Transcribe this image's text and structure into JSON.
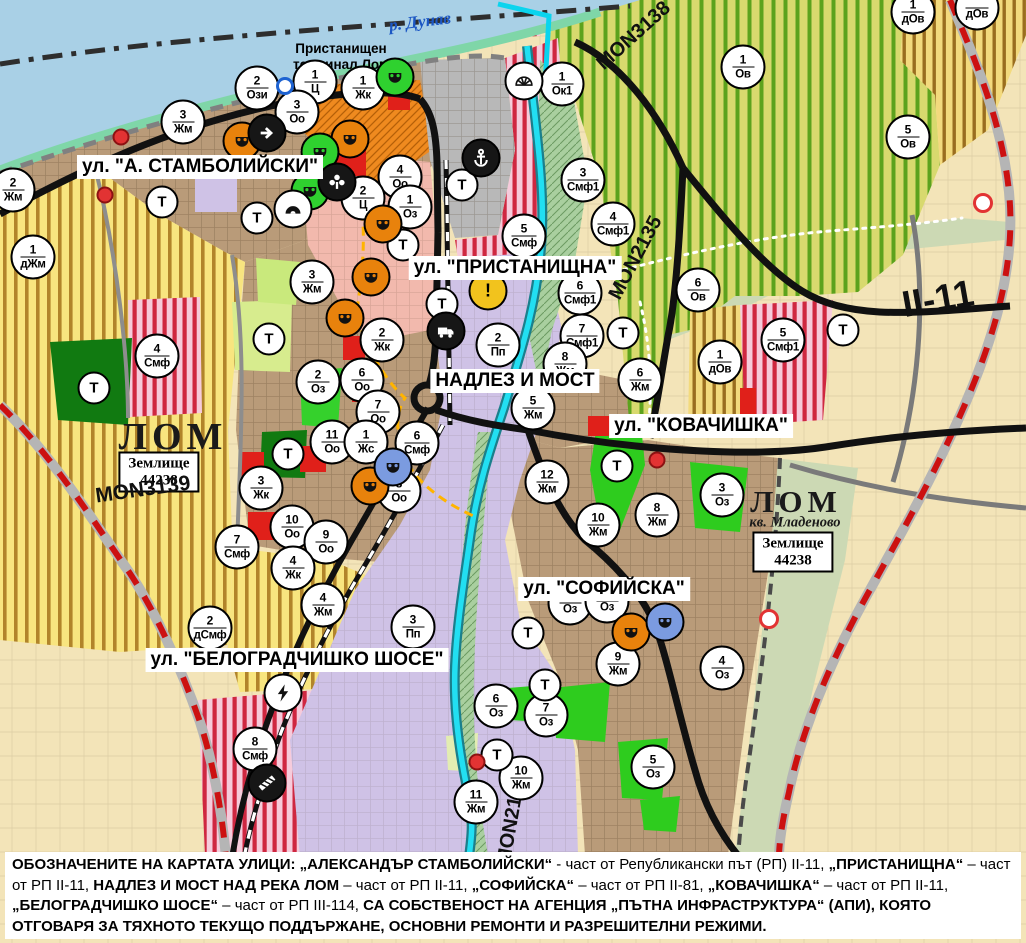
{
  "map": {
    "river_label": "р. Дунав",
    "terminal_label": "Пристанищен\nтерминал Лом",
    "t_label": "Т",
    "city_labels": [
      {
        "id": "lom-city",
        "text": "ЛОМ",
        "x": 173,
        "y": 437,
        "size": 38
      },
      {
        "id": "lom-mladenovo",
        "text": "ЛОМ",
        "x": 796,
        "y": 502,
        "size": 31
      }
    ],
    "district_label": {
      "text": "кв. Младеново",
      "x": 795,
      "y": 523
    },
    "land_plots": [
      {
        "line1": "Землище",
        "line2": "44238",
        "x": 159,
        "y": 472
      },
      {
        "line1": "Землище",
        "line2": "44238",
        "x": 793,
        "y": 552
      }
    ],
    "street_labels": [
      {
        "id": "stamboliyski",
        "text": "ул. \"А. СТАМБОЛИЙСКИ\"",
        "x": 200,
        "y": 167
      },
      {
        "id": "pristanishtna",
        "text": "ул. \"ПРИСТАНИЩНА\"",
        "x": 515,
        "y": 268
      },
      {
        "id": "nadlez-i-most",
        "text": "НАДЛЕЗ И МОСТ",
        "x": 515,
        "y": 381
      },
      {
        "id": "kovachishka",
        "text": "ул. \"КОВАЧИШКА\"",
        "x": 701,
        "y": 426
      },
      {
        "id": "sofiyska",
        "text": "ул. \"СОФИЙСКА\"",
        "x": 604,
        "y": 589
      },
      {
        "id": "belogradchishko-shose",
        "text": "ул. \"БЕЛОГРАДЧИШКО ШОСЕ\"",
        "x": 297,
        "y": 660
      }
    ],
    "road_labels": [
      {
        "id": "mon3139",
        "text": "MON3139",
        "x": 143,
        "y": 490,
        "rot": -8,
        "size": 21
      },
      {
        "id": "mon3138",
        "text": "MON3138",
        "x": 634,
        "y": 36,
        "rot": -42,
        "size": 20
      },
      {
        "id": "mon2135",
        "text": "MON2135",
        "x": 636,
        "y": 258,
        "rot": -62,
        "size": 20
      },
      {
        "id": "mon2136",
        "text": "MON2136",
        "x": 512,
        "y": 820,
        "rot": -80,
        "size": 20
      },
      {
        "id": "ii-11",
        "text": "II-11",
        "x": 938,
        "y": 299,
        "rot": -10,
        "size": 37
      }
    ],
    "zone_markers": [
      {
        "n": "2",
        "c": "Ози",
        "x": 257,
        "y": 88
      },
      {
        "n": "1",
        "c": "Ц",
        "x": 315,
        "y": 82
      },
      {
        "n": "1",
        "c": "Жк",
        "x": 363,
        "y": 88
      },
      {
        "n": "3",
        "c": "Оо",
        "x": 297,
        "y": 112
      },
      {
        "n": "1",
        "c": "Ок1",
        "x": 562,
        "y": 84
      },
      {
        "n": "3",
        "c": "Жм",
        "x": 183,
        "y": 122
      },
      {
        "n": "2",
        "c": "Жм",
        "x": 13,
        "y": 190
      },
      {
        "n": "1",
        "c": "дЖм",
        "x": 33,
        "y": 257
      },
      {
        "n": "3",
        "c": "Смф1",
        "x": 583,
        "y": 180
      },
      {
        "n": "4",
        "c": "Оо",
        "x": 400,
        "y": 177
      },
      {
        "n": "2",
        "c": "Ц",
        "x": 363,
        "y": 198
      },
      {
        "n": "1",
        "c": "Оз",
        "x": 410,
        "y": 207
      },
      {
        "n": "4",
        "c": "Смф1",
        "x": 613,
        "y": 224
      },
      {
        "n": "5",
        "c": "Смф",
        "x": 524,
        "y": 236
      },
      {
        "n": "3",
        "c": "Жм",
        "x": 312,
        "y": 282
      },
      {
        "n": "6",
        "c": "Смф1",
        "x": 580,
        "y": 293
      },
      {
        "n": "7",
        "c": "Смф1",
        "x": 582,
        "y": 336
      },
      {
        "n": "2",
        "c": "Пп",
        "x": 498,
        "y": 345
      },
      {
        "n": "8",
        "c": "Жм",
        "x": 565,
        "y": 364
      },
      {
        "n": "6",
        "c": "Жм",
        "x": 640,
        "y": 380
      },
      {
        "n": "5",
        "c": "Жм",
        "x": 533,
        "y": 408
      },
      {
        "n": "2",
        "c": "Жк",
        "x": 382,
        "y": 340
      },
      {
        "n": "4",
        "c": "Смф",
        "x": 157,
        "y": 356
      },
      {
        "n": "2",
        "c": "Оз",
        "x": 318,
        "y": 382
      },
      {
        "n": "6",
        "c": "Оо",
        "x": 362,
        "y": 380
      },
      {
        "n": "7",
        "c": "Оо",
        "x": 378,
        "y": 412
      },
      {
        "n": "11",
        "c": "Оо",
        "x": 332,
        "y": 442
      },
      {
        "n": "1",
        "c": "Жс",
        "x": 366,
        "y": 442
      },
      {
        "n": "6",
        "c": "Смф",
        "x": 417,
        "y": 443
      },
      {
        "n": "8",
        "c": "Оо",
        "x": 399,
        "y": 491
      },
      {
        "n": "3",
        "c": "Жк",
        "x": 261,
        "y": 488
      },
      {
        "n": "12",
        "c": "Жм",
        "x": 547,
        "y": 482
      },
      {
        "n": "8",
        "c": "Жм",
        "x": 657,
        "y": 515
      },
      {
        "n": "3",
        "c": "Оз",
        "x": 722,
        "y": 495
      },
      {
        "n": "10",
        "c": "Жм",
        "x": 598,
        "y": 525
      },
      {
        "n": "10",
        "c": "Оо",
        "x": 292,
        "y": 527
      },
      {
        "n": "9",
        "c": "Оо",
        "x": 326,
        "y": 542
      },
      {
        "n": "7",
        "c": "Смф",
        "x": 237,
        "y": 547
      },
      {
        "n": "4",
        "c": "Жк",
        "x": 293,
        "y": 568
      },
      {
        "n": "4",
        "c": "Жм",
        "x": 323,
        "y": 605
      },
      {
        "n": "2",
        "c": "дСмф",
        "x": 210,
        "y": 628
      },
      {
        "n": "3",
        "c": "Пп",
        "x": 413,
        "y": 627
      },
      {
        "n": "8",
        "c": "Смф",
        "x": 255,
        "y": 749
      },
      {
        "n": "",
        "c": "Оз",
        "x": 570,
        "y": 603
      },
      {
        "n": "",
        "c": "Оз",
        "x": 607,
        "y": 601
      },
      {
        "n": "9",
        "c": "Жм",
        "x": 618,
        "y": 664
      },
      {
        "n": "4",
        "c": "Оз",
        "x": 722,
        "y": 668
      },
      {
        "n": "6",
        "c": "Оз",
        "x": 496,
        "y": 706
      },
      {
        "n": "7",
        "c": "Оз",
        "x": 546,
        "y": 715
      },
      {
        "n": "5",
        "c": "Оз",
        "x": 653,
        "y": 767
      },
      {
        "n": "10",
        "c": "Жм",
        "x": 521,
        "y": 778
      },
      {
        "n": "11",
        "c": "Жм",
        "x": 476,
        "y": 802
      },
      {
        "n": "1",
        "c": "Ов",
        "x": 743,
        "y": 67
      },
      {
        "n": "5",
        "c": "Ов",
        "x": 908,
        "y": 137
      },
      {
        "n": "1",
        "c": "дОв",
        "x": 913,
        "y": 12
      },
      {
        "n": "",
        "c": "дОв",
        "x": 977,
        "y": 8
      },
      {
        "n": "6",
        "c": "Ов",
        "x": 698,
        "y": 290
      },
      {
        "n": "1",
        "c": "дОв",
        "x": 720,
        "y": 362
      },
      {
        "n": "5",
        "c": "Смф1",
        "x": 783,
        "y": 340
      }
    ],
    "t_markers": [
      {
        "x": 162,
        "y": 202
      },
      {
        "x": 257,
        "y": 218
      },
      {
        "x": 462,
        "y": 185
      },
      {
        "x": 403,
        "y": 245
      },
      {
        "x": 442,
        "y": 304
      },
      {
        "x": 269,
        "y": 339
      },
      {
        "x": 94,
        "y": 388
      },
      {
        "x": 288,
        "y": 454
      },
      {
        "x": 623,
        "y": 333
      },
      {
        "x": 843,
        "y": 330
      },
      {
        "x": 617,
        "y": 466
      },
      {
        "x": 528,
        "y": 633
      },
      {
        "x": 545,
        "y": 685
      },
      {
        "x": 497,
        "y": 755
      }
    ],
    "icon_markers": [
      {
        "type": "monument-icon",
        "variant": "bgorange",
        "x": 242,
        "y": 141
      },
      {
        "type": "monument-icon",
        "variant": "bgorange",
        "x": 350,
        "y": 139
      },
      {
        "type": "monument-icon",
        "variant": "bgorange",
        "x": 383,
        "y": 224
      },
      {
        "type": "monument-icon",
        "variant": "bgorange",
        "x": 371,
        "y": 277
      },
      {
        "type": "monument-icon",
        "variant": "bgorange",
        "x": 345,
        "y": 318
      },
      {
        "type": "monument-icon",
        "variant": "bgorange",
        "x": 370,
        "y": 486
      },
      {
        "type": "monument-icon",
        "variant": "bgorange",
        "x": 631,
        "y": 632
      },
      {
        "type": "monument-icon",
        "variant": "bggreen",
        "x": 395,
        "y": 77
      },
      {
        "type": "monument-icon",
        "variant": "bggreen",
        "x": 320,
        "y": 152
      },
      {
        "type": "monument-icon",
        "variant": "bggreen",
        "x": 310,
        "y": 191
      },
      {
        "type": "monument-icon",
        "variant": "bgblue",
        "x": 393,
        "y": 467
      },
      {
        "type": "monument-icon",
        "variant": "bgblue",
        "x": 665,
        "y": 622
      },
      {
        "type": "arrow-icon",
        "variant": "bgblack",
        "x": 267,
        "y": 133
      },
      {
        "type": "fountain-icon",
        "variant": "bgblack",
        "x": 337,
        "y": 182
      },
      {
        "type": "mound-icon",
        "variant": "bgwhite",
        "x": 293,
        "y": 209
      },
      {
        "type": "dock-icon",
        "variant": "bgwhite",
        "x": 524,
        "y": 81
      },
      {
        "type": "anchor-icon",
        "variant": "bgblack",
        "x": 481,
        "y": 158
      },
      {
        "type": "warning-icon",
        "variant": "bgyellow",
        "x": 488,
        "y": 291
      },
      {
        "type": "truck-icon",
        "variant": "bgblack",
        "x": 446,
        "y": 331
      },
      {
        "type": "lightning-icon",
        "variant": "bgwhite",
        "x": 283,
        "y": 693
      },
      {
        "type": "railcrossing-icon",
        "variant": "bgblack",
        "x": 267,
        "y": 783
      }
    ],
    "dot_markers": [
      {
        "kind": "dot",
        "x": 121,
        "y": 137
      },
      {
        "kind": "dot",
        "x": 105,
        "y": 195
      },
      {
        "kind": "dot",
        "x": 657,
        "y": 460
      },
      {
        "kind": "dot",
        "x": 477,
        "y": 762
      },
      {
        "kind": "ring",
        "x": 769,
        "y": 619
      },
      {
        "kind": "ring",
        "x": 983,
        "y": 203
      },
      {
        "kind": "bluering",
        "x": 285,
        "y": 86
      }
    ],
    "legend": {
      "segments": [
        {
          "t": "ОБОЗНАЧЕНИТЕ НА КАРТАТА УЛИЦИ: „АЛЕКСАНДЪР СТАМБОЛИЙСКИ“",
          "b": true
        },
        {
          "t": " - част от Републикански път (РП) II-11, ",
          "b": false
        },
        {
          "t": "„ПРИСТАНИЩНА“",
          "b": true
        },
        {
          "t": " – част от РП II-11, ",
          "b": false
        },
        {
          "t": "НАДЛЕЗ И МОСТ НАД РЕКА ЛОМ",
          "b": true
        },
        {
          "t": " – част от РП II-11, ",
          "b": false
        },
        {
          "t": "„СОФИЙСКА“",
          "b": true
        },
        {
          "t": " – част от РП II-81, ",
          "b": false
        },
        {
          "t": "„КОВАЧИШКА“",
          "b": true
        },
        {
          "t": " – част от РП II-11, ",
          "b": false
        },
        {
          "t": "„БЕЛОГРАДЧИШКО ШОСЕ“",
          "b": true
        },
        {
          "t": " – част от РП III-114, ",
          "b": false
        },
        {
          "t": "СА СОБСТВЕНОСТ НА АГЕНЦИЯ „ПЪТНА ИНФРАСТРУКТУРА“ (АПИ), КОЯТО ОТГОВАРЯ ЗА ТЯХНОТО ТЕКУЩО ПОДДЪРЖАНЕ, ОСНОВНИ РЕМОНТИ И РАЗРЕШИТЕЛНИ РЕЖИМИ.",
          "b": true
        }
      ]
    },
    "colors": {
      "danube_water": "#a9d0e6",
      "lom_river": "#22dff2",
      "urban_brown": "#b99b79",
      "fields_beige": "#f3e4b8",
      "vineyard_bg": "#d8d96e",
      "vineyard_stripe": "#5ca21d",
      "smf_bg": "#f6cbdb",
      "smf_stripe": "#cf2740",
      "agri_bg": "#f8e57f",
      "agri_stripe": "#aa7a21",
      "industrial_purple": "#cfc2e6",
      "park_dark_green": "#117a11",
      "park_bright_green": "#2ecc1e",
      "center_red": "#e0201a",
      "port_orange": "#ef8a1f",
      "major_road_red": "#cc1111",
      "road_black": "#111111",
      "label_bg": "#ffffff"
    }
  }
}
